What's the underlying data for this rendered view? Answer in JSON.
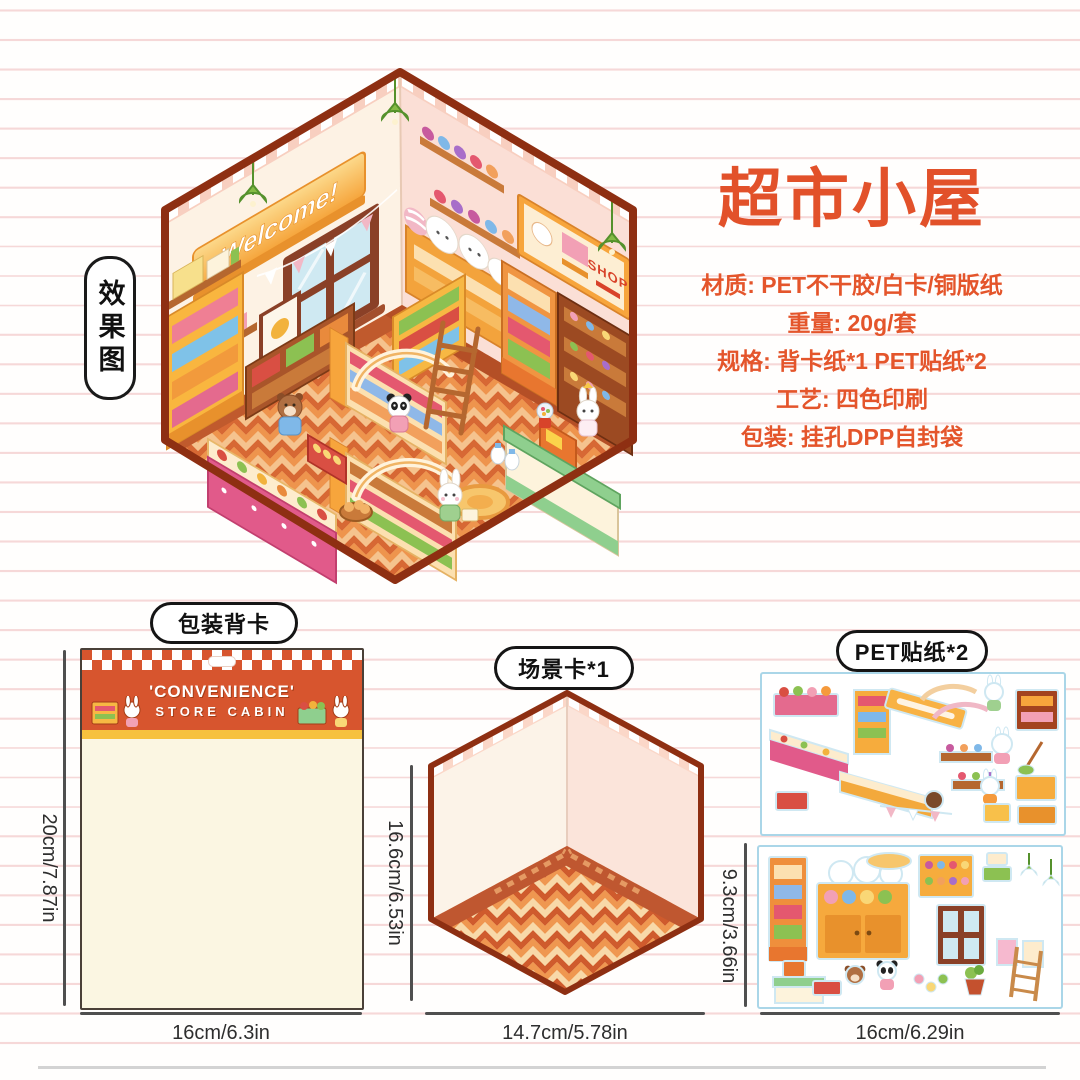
{
  "page": {
    "background": "#fffefd",
    "rule_color": "#f6d8d8",
    "accent": "#e2512a"
  },
  "effect_tag": {
    "label": "效果图"
  },
  "info": {
    "title": "超市小屋",
    "specs": [
      "材质: PET不干胶/白卡/铜版纸",
      "重量: 20g/套",
      "规格: 背卡纸*1 PET贴纸*2",
      "工艺: 四色印刷",
      "包装: 挂孔DPP自封袋"
    ]
  },
  "illustration": {
    "banner": "Welcome!",
    "sign": "SHOP"
  },
  "backing_card": {
    "label": "包装背卡",
    "title_line1": "'CONVENIENCE'",
    "title_line2": "STORE CABIN",
    "height": "20cm/7.87in",
    "width": "16cm/6.3in"
  },
  "scene_card": {
    "label": "场景卡*1",
    "height": "16.6cm/6.53in",
    "width": "14.7cm/5.78in"
  },
  "stickers": {
    "label": "PET贴纸*2",
    "sheet_count": "2",
    "height": "9.3cm/3.66in",
    "width": "16cm/6.29in"
  },
  "colors": {
    "outline": "#8e2f12",
    "card_header": "#d7552e",
    "card_strip": "#f6c13e",
    "wall_left": "#fdf2e4",
    "wall_right": "#fbdfd6",
    "floor_rust": "#cf5b2d",
    "floor_orange": "#ef9750",
    "floor_cream": "#f8d9a9"
  }
}
